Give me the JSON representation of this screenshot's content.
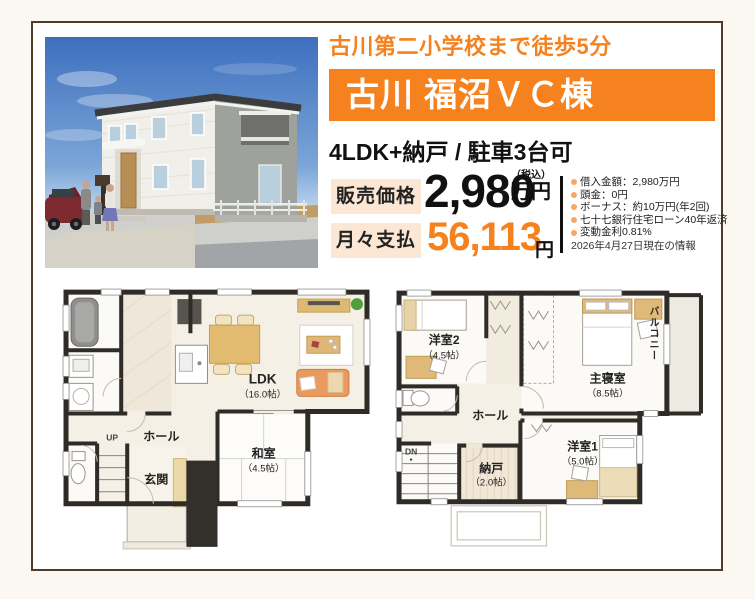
{
  "colors": {
    "accent_orange": "#f5821f",
    "price_label_bg": "#fbe7d3",
    "frame_brown": "#503c28",
    "bullet_orange": "#f3a86a"
  },
  "header": {
    "school_distance": "古川第二小学校まで徒歩5分",
    "title": "古川 福沼ＶＣ棟",
    "layout_info": "4LDK+納戸 / 駐車3台可"
  },
  "price": {
    "sale_label": "販売価格",
    "sale_value": "2,980",
    "sale_tax_note": "（税込）",
    "sale_unit": "万円",
    "monthly_label": "月々支払",
    "monthly_value": "56,113",
    "monthly_unit": "円"
  },
  "loan": {
    "items": [
      "借入金額：2,980万円",
      "頭金：0円",
      "ボーナス：約10万円(年2回)",
      "七十七銀行住宅ローン40年返済",
      "変動金利0.81%"
    ],
    "date_note": "2026年4月27日現在の情報"
  },
  "floorplan_1f": {
    "ldk": "LDK",
    "ldk_size": "（16.0帖）",
    "washitsu": "和室",
    "washitsu_size": "（4.5帖）",
    "hall": "ホール",
    "genkan": "玄関",
    "up": "UP"
  },
  "floorplan_2f": {
    "yoshitsu2": "洋室2",
    "yoshitsu2_size": "（4.5帖）",
    "master": "主寝室",
    "master_size": "（8.5帖）",
    "balcony": "バルコニー",
    "hall": "ホール",
    "nando": "納戸",
    "nando_size": "（2.0帖）",
    "yoshitsu1": "洋室1",
    "yoshitsu1_size": "（5.0帖）",
    "dn": "DN"
  }
}
